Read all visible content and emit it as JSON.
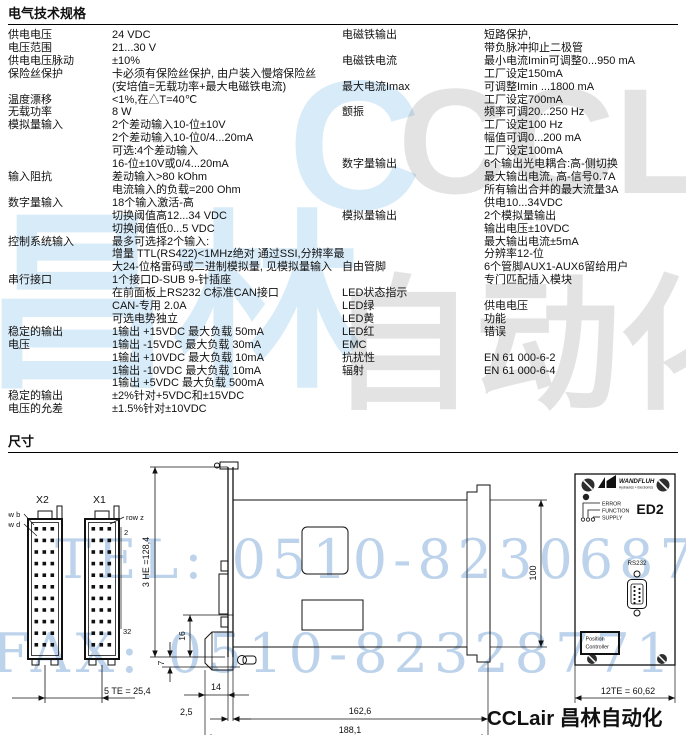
{
  "page": {
    "section1_title": "电气技术规格",
    "section2_title": "尺寸"
  },
  "specs": {
    "left": [
      {
        "label": [
          "供电电压"
        ],
        "lines": [
          "24 VDC"
        ]
      },
      {
        "label": [
          "电压范围"
        ],
        "lines": [
          "21...30 V"
        ]
      },
      {
        "label": [
          "供电电压脉动"
        ],
        "lines": [
          "±10%"
        ]
      },
      {
        "label": [
          "保险丝保护"
        ],
        "lines": [
          "卡必须有保险丝保护, 由户装入慢熔保险丝",
          "(安培值=无载功率+最大电磁铁电流)"
        ]
      },
      {
        "label": [
          "温度漂移"
        ],
        "lines": [
          "<1%,在△T=40℃"
        ]
      },
      {
        "label": [
          "无载功率"
        ],
        "lines": [
          "8 W"
        ]
      },
      {
        "label": [
          "模拟量输入"
        ],
        "lines": [
          "2个差动输入10-位±10V",
          "2个差动输入10-位0/4...20mA",
          "可选:4个差动输入",
          "16-位±10V或0/4...20mA"
        ]
      },
      {
        "label": [
          "输入阻抗"
        ],
        "lines": [
          "差动输入>80 kOhm",
          "电流输入的负载=200 Ohm"
        ]
      },
      {
        "label": [
          "数字量输入"
        ],
        "lines": [
          "18个输入激活-高",
          "切换阈值高12...34 VDC",
          "切换阈值低0...5 VDC"
        ]
      },
      {
        "label": [
          "控制系统输入"
        ],
        "lines": [
          "最多可选择2个输入:",
          "增量 TTL(RS422)<1MHz绝对 通过SSI,分辨率最",
          "大24-位格雷码或二进制模拟量, 见模拟量输入"
        ]
      },
      {
        "label": [
          "串行接口"
        ],
        "lines": [
          "1个接口D-SUB 9-针插座",
          "在前面板上RS232 C标准CAN接口",
          "CAN-专用 2.0A",
          "可选电势独立"
        ]
      },
      {
        "label": [
          "稳定的输出",
          "电压"
        ],
        "lines": [
          "1输出 +15VDC 最大负载 50mA",
          "1输出 -15VDC 最大负载 30mA",
          "1输出 +10VDC 最大负载 10mA",
          "1输出 -10VDC 最大负载 10mA",
          "1输出 +5VDC 最大负载 500mA"
        ]
      },
      {
        "label": [
          "稳定的输出",
          "电压的允差"
        ],
        "lines": [
          "±2%针对+5VDC和±15VDC",
          "±1.5%针对±10VDC"
        ]
      }
    ],
    "right": [
      {
        "label": [
          "电磁铁输出"
        ],
        "lines": [
          "短路保护,",
          "带负脉冲抑止二极管"
        ]
      },
      {
        "label": [
          "电磁铁电流"
        ],
        "lines": [
          "最小电流Imin可调整0...950 mA",
          "工厂设定150mA"
        ]
      },
      {
        "label": [
          "最大电流Imax"
        ],
        "lines": [
          "可调整Imin ...1800 mA",
          "工厂设定700mA"
        ]
      },
      {
        "label": [
          "颤振"
        ],
        "lines": [
          "频率可调20...250 Hz",
          "工厂设定100 Hz",
          "幅值可调0...200 mA",
          "工厂设定100mA"
        ]
      },
      {
        "label": [
          "数字量输出"
        ],
        "lines": [
          "6个输出光电耦合:高-侧切换",
          "最大输出电流, 高-信号0.7A",
          "所有输出合并的最大流量3A",
          "供电10...34VDC"
        ]
      },
      {
        "label": [
          "模拟量输出"
        ],
        "lines": [
          "2个模拟量输出",
          "输出电压±10VDC",
          "最大输出电流±5mA",
          "分辨率12-位"
        ]
      },
      {
        "label": [
          "自由管脚"
        ],
        "lines": [
          "6个管脚AUX1-AUX6留给用户",
          "专门匹配插入模块"
        ]
      },
      {
        "label": [
          "LED状态指示"
        ],
        "lines": []
      },
      {
        "label": [
          "LED绿"
        ],
        "lines": [
          "供电电压"
        ]
      },
      {
        "label": [
          "LED黄"
        ],
        "lines": [
          "功能"
        ]
      },
      {
        "label": [
          "LED红"
        ],
        "lines": [
          "错误"
        ]
      },
      {
        "label": [
          "EMC"
        ],
        "lines": []
      },
      {
        "label": [
          "抗扰性"
        ],
        "lines": [
          "EN 61 000-6-2"
        ]
      },
      {
        "label": [
          "辐射"
        ],
        "lines": [
          "EN 61 000-6-4"
        ]
      }
    ]
  },
  "drawing": {
    "connectors": {
      "x2": "X2",
      "x1": "X1",
      "row_b": "row b",
      "row_d": "row d",
      "row_z": "row z",
      "pin2": "2",
      "pin32": "32",
      "dim_5te": "5 TE = 25,4"
    },
    "side_view": {
      "dim_3he": "3 HE =128,4",
      "dim_16": "16",
      "dim_7": "7",
      "dim_14": "14",
      "dim_2_5": "2,5",
      "dim_162_6": "162,6",
      "dim_188_1": "188,1",
      "dim_100": "100"
    },
    "front_panel": {
      "brand": "WANDFLUH",
      "brand_sub": "Hydraulics + Electronics",
      "led_error": "ERROR",
      "led_function": "FUNCTION",
      "led_supply": "SUPPLY",
      "model": "ED2",
      "rs232": "RS232",
      "pos_line1": "Position",
      "pos_line2": "Controller",
      "dim_12te": "12TE = 60,62"
    },
    "footer_logo": "CCLair 昌林自动化"
  },
  "watermarks": {
    "cn1": "昌林",
    "c": "C",
    "cclair": "CCLair",
    "cn2": "自动化",
    "tel": "TEL: 0510-82306871",
    "fax": "FAX: 0510-82328771"
  }
}
